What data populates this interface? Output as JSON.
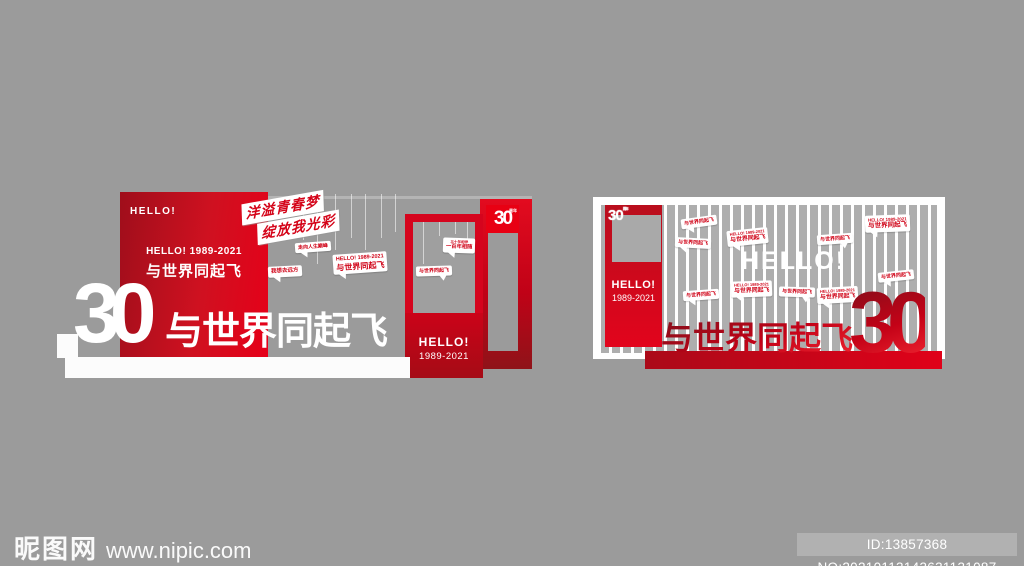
{
  "page": {
    "background": "#9b9b9b"
  },
  "colors": {
    "accent_red": "#d5041d",
    "bright_red": "#e60019",
    "dark_red": "#8f1319",
    "panel_white": "#ffffff",
    "background_gray": "#9b9b9b"
  },
  "watermark": {
    "site_name": "昵图网",
    "site_url": "www.nipic.com",
    "id_text": "ID:13857368 NO:20210113143631131087"
  },
  "left_display": {
    "panel_hello": "HELLO!",
    "panel_line1": "HELLO! 1989-2021",
    "panel_line2": "与世界同起飞",
    "slogan_line1": "洋溢青春梦",
    "slogan_line2": "绽放我光彩",
    "badge_number": "30",
    "badge_label": "周年",
    "door_hello": "HELLO!",
    "door_years": "1989-2021",
    "big_number": "30",
    "big_text": "与世界同起飞",
    "bubbles": [
      {
        "type": "small",
        "text": "走向人生巅峰",
        "x": 230,
        "y": 50,
        "rot": -4,
        "fs": 5,
        "tail": "l"
      },
      {
        "type": "small",
        "text": "我想去远方",
        "x": 203,
        "y": 74,
        "rot": -3,
        "fs": 5.5,
        "tail": "l"
      },
      {
        "type": "large",
        "line1": "HELLO! 1989-2021",
        "line2": "与世界同起飞",
        "x": 268,
        "y": 61,
        "rot": -4,
        "s": 1.3,
        "tail": "l"
      }
    ],
    "frame_bubbles": [
      {
        "type": "large",
        "line1": "三十年相伴",
        "line2": "一百年相随",
        "x": 30,
        "y": 16,
        "rot": 2,
        "s": 0.85,
        "tail": "l"
      },
      {
        "type": "small",
        "text": "与世界同起飞",
        "x": 3,
        "y": 44,
        "rot": -2,
        "fs": 5,
        "tail": "r"
      }
    ],
    "strings": [
      {
        "x": 238,
        "y": 2,
        "h": 46
      },
      {
        "x": 252,
        "y": 2,
        "h": 70
      },
      {
        "x": 270,
        "y": 2,
        "h": 56
      },
      {
        "x": 286,
        "y": 2,
        "h": 44
      },
      {
        "x": 300,
        "y": 2,
        "h": 56
      },
      {
        "x": 316,
        "y": 2,
        "h": 44
      },
      {
        "x": 330,
        "y": 2,
        "h": 38
      }
    ],
    "frame_strings": [
      {
        "x": 10,
        "y": 0,
        "h": 42
      },
      {
        "x": 26,
        "y": 0,
        "h": 14
      },
      {
        "x": 42,
        "y": 0,
        "h": 12
      },
      {
        "x": 54,
        "y": 0,
        "h": 28
      }
    ]
  },
  "right_display": {
    "logo_number": "30",
    "logo_label": "周年",
    "column_hello": "HELLO!",
    "column_years": "1989-2021",
    "big_hello": "HELLO!",
    "big_text": "与世界同起飞",
    "big_number": "30",
    "bubbles": [
      {
        "type": "small",
        "text": "与世界同起飞",
        "x": 88,
        "y": 20,
        "rot": -8,
        "fs": 5,
        "tail": "l"
      },
      {
        "type": "large",
        "line1": "HELLO! 1989-2021",
        "line2": "与世界同起飞",
        "x": 134,
        "y": 32,
        "rot": -6,
        "s": 0.95,
        "tail": "l"
      },
      {
        "type": "small",
        "text": "与世界同起飞",
        "x": 82,
        "y": 41,
        "rot": 3,
        "fs": 5,
        "tail": "l"
      },
      {
        "type": "small",
        "text": "与世界同起飞",
        "x": 224,
        "y": 37,
        "rot": -4,
        "fs": 5,
        "tail": "r"
      },
      {
        "type": "large",
        "line1": "HELLO! 1989-2021",
        "line2": "与世界同起飞",
        "x": 272,
        "y": 18,
        "rot": -2,
        "s": 1.05,
        "tail": "l"
      },
      {
        "type": "small",
        "text": "与世界同起飞",
        "x": 285,
        "y": 74,
        "rot": -6,
        "fs": 5,
        "tail": "l"
      },
      {
        "type": "small",
        "text": "与世界同起飞",
        "x": 90,
        "y": 93,
        "rot": -4,
        "fs": 5,
        "tail": "l"
      },
      {
        "type": "large",
        "line1": "HELLO! 1989-2021",
        "line2": "与世界同起飞",
        "x": 138,
        "y": 84,
        "rot": -2,
        "s": 0.95,
        "tail": "l"
      },
      {
        "type": "small",
        "text": "与世界同起飞",
        "x": 186,
        "y": 90,
        "rot": 2,
        "fs": 5,
        "tail": "r"
      },
      {
        "type": "large",
        "line1": "HELLO! 1989-2021",
        "line2": "与世界同起飞",
        "x": 224,
        "y": 90,
        "rot": -3,
        "s": 0.95,
        "tail": "l"
      }
    ]
  }
}
